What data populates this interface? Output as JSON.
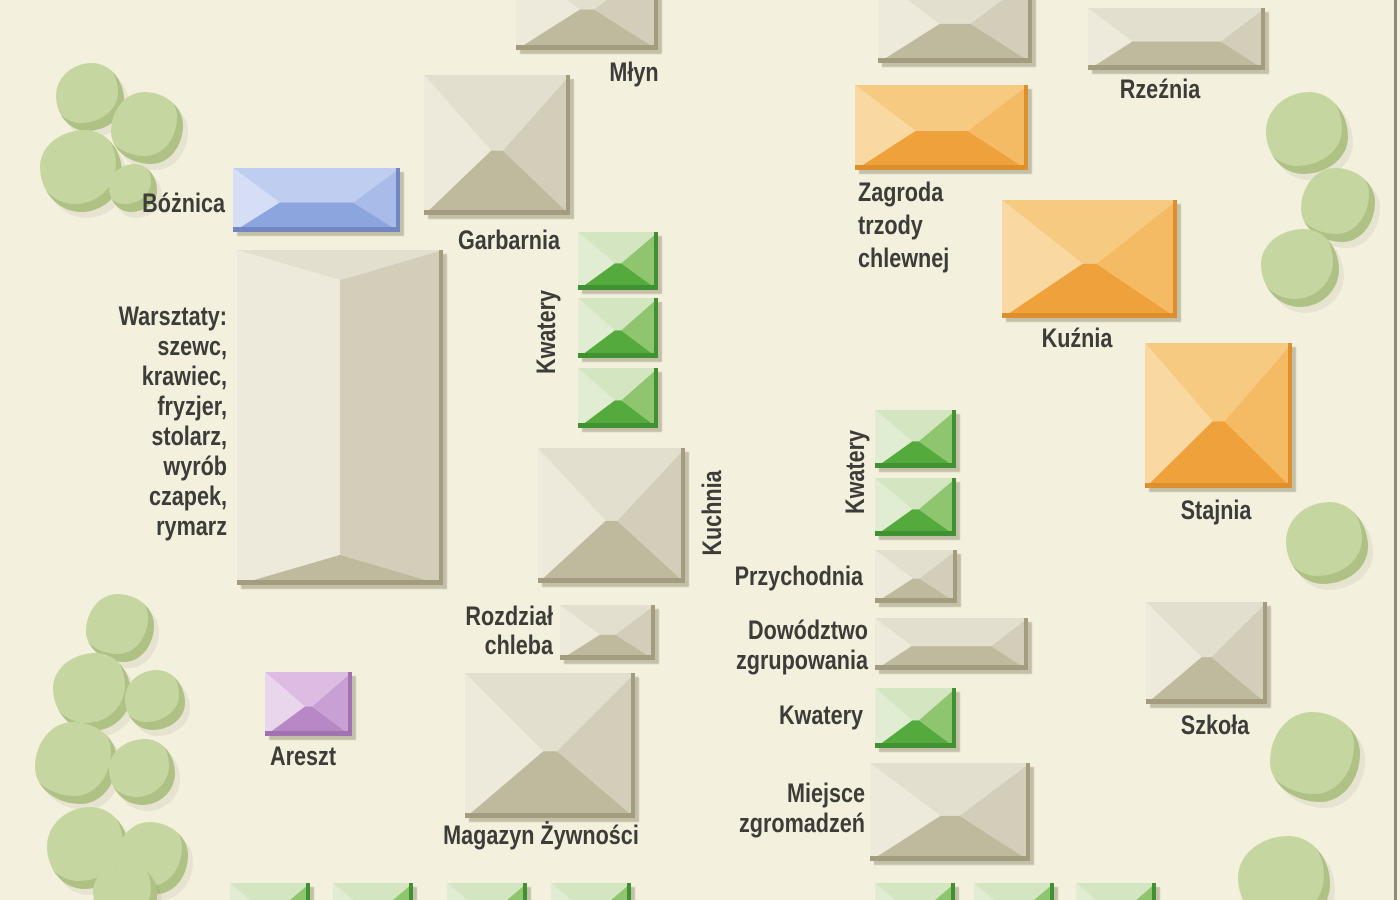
{
  "map": {
    "background_color": "#f3f1de",
    "ink_color": "#3d3c38",
    "right_border_color": "#8d8b79",
    "tree_color": "#c6d6a0",
    "palettes": {
      "tan": {
        "top": "#e2dfce",
        "left": "#edeadc",
        "right": "#d3ceb9",
        "bottom": "#bfb99d",
        "edge": "#a49c7e"
      },
      "green": {
        "top": "#d3e5c1",
        "left": "#e0edd3",
        "right": "#8fc56e",
        "bottom": "#55aa3e",
        "edge": "#3f9132"
      },
      "orange": {
        "top": "#f7ca82",
        "left": "#f9d8a2",
        "right": "#f4bb64",
        "bottom": "#efa23c",
        "edge": "#dc8f2c"
      },
      "blue": {
        "top": "#bfcef0",
        "left": "#d6def6",
        "right": "#a9bbe9",
        "bottom": "#8da5de",
        "edge": "#7286c2"
      },
      "purple": {
        "top": "#dcbce2",
        "left": "#e9d6ec",
        "right": "#c9a0d4",
        "bottom": "#b888c6",
        "edge": "#a172b0"
      }
    },
    "buildings": [
      {
        "id": "mlyn",
        "label": "Młyn",
        "color": "tan",
        "orient": "h",
        "x": 516,
        "y": -38,
        "w": 142,
        "h": 88
      },
      {
        "id": "unlabeled-top",
        "label": "",
        "color": "tan",
        "orient": "h",
        "x": 878,
        "y": -22,
        "w": 154,
        "h": 85
      },
      {
        "id": "rzeznia",
        "label": "Rzeźnia",
        "color": "tan",
        "orient": "h",
        "x": 1088,
        "y": 8,
        "w": 177,
        "h": 62
      },
      {
        "id": "boznica",
        "label": "Bóżnica",
        "color": "blue",
        "orient": "h",
        "x": 233,
        "y": 168,
        "w": 167,
        "h": 64
      },
      {
        "id": "garbarnia",
        "label": "Garbarnia",
        "color": "tan",
        "orient": "h",
        "x": 424,
        "y": 75,
        "w": 146,
        "h": 140
      },
      {
        "id": "warsztaty",
        "label": "Warsztaty",
        "color": "tan",
        "orient": "v",
        "x": 237,
        "y": 250,
        "w": 206,
        "h": 335
      },
      {
        "id": "kwatery-l1",
        "label": "Kwatery",
        "color": "green",
        "orient": "h",
        "x": 578,
        "y": 232,
        "w": 80,
        "h": 58
      },
      {
        "id": "kwatery-l2",
        "label": "Kwatery",
        "color": "green",
        "orient": "h",
        "x": 578,
        "y": 298,
        "w": 80,
        "h": 60
      },
      {
        "id": "kwatery-l3",
        "label": "Kwatery",
        "color": "green",
        "orient": "h",
        "x": 578,
        "y": 368,
        "w": 80,
        "h": 60
      },
      {
        "id": "kuchnia",
        "label": "Kuchnia",
        "color": "tan",
        "orient": "h",
        "x": 538,
        "y": 448,
        "w": 147,
        "h": 135
      },
      {
        "id": "rozdzial-chleba",
        "label": "Rozdział chleba",
        "color": "tan",
        "orient": "h",
        "x": 560,
        "y": 605,
        "w": 95,
        "h": 55
      },
      {
        "id": "magazyn-zywnosci",
        "label": "Magazyn Żywności",
        "color": "tan",
        "orient": "h",
        "x": 465,
        "y": 673,
        "w": 170,
        "h": 145
      },
      {
        "id": "areszt",
        "label": "Areszt",
        "color": "purple",
        "orient": "h",
        "x": 265,
        "y": 672,
        "w": 87,
        "h": 64
      },
      {
        "id": "zagroda",
        "label": "Zagroda trzody chlewnej",
        "color": "orange",
        "orient": "h",
        "x": 855,
        "y": 85,
        "w": 173,
        "h": 85
      },
      {
        "id": "kuznia",
        "label": "Kuźnia",
        "color": "orange",
        "orient": "h",
        "x": 1002,
        "y": 200,
        "w": 175,
        "h": 118
      },
      {
        "id": "stajnia",
        "label": "Stajnia",
        "color": "orange",
        "orient": "h",
        "x": 1145,
        "y": 343,
        "w": 147,
        "h": 145
      },
      {
        "id": "kwatery-r1",
        "label": "Kwatery",
        "color": "green",
        "orient": "h",
        "x": 875,
        "y": 410,
        "w": 81,
        "h": 58
      },
      {
        "id": "kwatery-r2",
        "label": "Kwatery",
        "color": "green",
        "orient": "h",
        "x": 875,
        "y": 478,
        "w": 81,
        "h": 58
      },
      {
        "id": "przychodnia",
        "label": "Przychodnia",
        "color": "tan",
        "orient": "h",
        "x": 875,
        "y": 550,
        "w": 82,
        "h": 53
      },
      {
        "id": "dowodztwo",
        "label": "Dowództwo zgrupowania",
        "color": "tan",
        "orient": "h",
        "x": 875,
        "y": 618,
        "w": 153,
        "h": 52
      },
      {
        "id": "kwatery-single",
        "label": "Kwatery",
        "color": "green",
        "orient": "h",
        "x": 875,
        "y": 688,
        "w": 81,
        "h": 60
      },
      {
        "id": "miejsce-zgromadzen",
        "label": "Miejsce zgromadzeń",
        "color": "tan",
        "orient": "h",
        "x": 870,
        "y": 763,
        "w": 160,
        "h": 98
      },
      {
        "id": "szkola",
        "label": "Szkoła",
        "color": "tan",
        "orient": "h",
        "x": 1146,
        "y": 602,
        "w": 121,
        "h": 102
      },
      {
        "id": "green-bottom-1",
        "label": "",
        "color": "green",
        "orient": "h",
        "x": 230,
        "y": 883,
        "w": 80,
        "h": 58
      },
      {
        "id": "green-bottom-2",
        "label": "",
        "color": "green",
        "orient": "h",
        "x": 333,
        "y": 883,
        "w": 80,
        "h": 58
      },
      {
        "id": "green-bottom-3",
        "label": "",
        "color": "green",
        "orient": "h",
        "x": 447,
        "y": 883,
        "w": 80,
        "h": 58
      },
      {
        "id": "green-bottom-4",
        "label": "",
        "color": "green",
        "orient": "h",
        "x": 551,
        "y": 883,
        "w": 80,
        "h": 58
      },
      {
        "id": "green-bottom-5",
        "label": "",
        "color": "green",
        "orient": "h",
        "x": 875,
        "y": 883,
        "w": 80,
        "h": 58
      },
      {
        "id": "green-bottom-6",
        "label": "",
        "color": "green",
        "orient": "h",
        "x": 974,
        "y": 883,
        "w": 80,
        "h": 58
      },
      {
        "id": "green-bottom-7",
        "label": "",
        "color": "green",
        "orient": "h",
        "x": 1076,
        "y": 883,
        "w": 80,
        "h": 58
      }
    ],
    "labels": [
      {
        "id": "mlyn",
        "text": "Młyn",
        "x": 634,
        "y": 57,
        "align": "center"
      },
      {
        "id": "rzeznia",
        "text": "Rzeźnia",
        "x": 1160,
        "y": 74,
        "align": "center"
      },
      {
        "id": "boznica",
        "text": "Bóżnica",
        "x": 225,
        "y": 188,
        "align": "right"
      },
      {
        "id": "garbarnia",
        "text": "Garbarnia",
        "x": 509,
        "y": 225,
        "align": "center"
      },
      {
        "id": "warsztaty",
        "text": "Warsztaty:\nszewc,\nkrawiec,\nfryzjer,\nstolarz,\nwyrób\nczapek,\nrymarz",
        "x": 227,
        "y": 301,
        "align": "right"
      },
      {
        "id": "kwatery-left",
        "text": "Kwatery",
        "x": 546,
        "y": 332,
        "align": "center",
        "rotate": true
      },
      {
        "id": "kuchnia",
        "text": "Kuchnia",
        "x": 712,
        "y": 513,
        "align": "center",
        "rotate": true
      },
      {
        "id": "rozdzial-chleba",
        "text": "Rozdział\nchleba",
        "x": 553,
        "y": 602,
        "align": "right",
        "lh": 29
      },
      {
        "id": "magazyn-zywnosci",
        "text": "Magazyn Żywności",
        "x": 541,
        "y": 820,
        "align": "center"
      },
      {
        "id": "areszt",
        "text": "Areszt",
        "x": 303,
        "y": 741,
        "align": "center"
      },
      {
        "id": "zagroda",
        "text": "Zagroda\ntrzody\nchlewnej",
        "x": 858,
        "y": 176,
        "align": "left",
        "lh": 33
      },
      {
        "id": "kuznia",
        "text": "Kuźnia",
        "x": 1077,
        "y": 323,
        "align": "center"
      },
      {
        "id": "stajnia",
        "text": "Stajnia",
        "x": 1216,
        "y": 495,
        "align": "center"
      },
      {
        "id": "kwatery-right",
        "text": "Kwatery",
        "x": 855,
        "y": 472,
        "align": "center",
        "rotate": true
      },
      {
        "id": "przychodnia",
        "text": "Przychodnia",
        "x": 863,
        "y": 561,
        "align": "right"
      },
      {
        "id": "dowodztwo",
        "text": "Dowództwo\nzgrupowania",
        "x": 868,
        "y": 615,
        "align": "right",
        "lh": 30
      },
      {
        "id": "kwatery-single",
        "text": "Kwatery",
        "x": 863,
        "y": 700,
        "align": "right"
      },
      {
        "id": "miejsce-zgromadzen",
        "text": "Miejsce\nzgromadzeń",
        "x": 865,
        "y": 778,
        "align": "right",
        "lh": 30
      },
      {
        "id": "szkola",
        "text": "Szkoła",
        "x": 1215,
        "y": 710,
        "align": "center"
      }
    ],
    "trees": [
      {
        "x": 90,
        "y": 97,
        "r": 34
      },
      {
        "x": 147,
        "y": 128,
        "r": 36
      },
      {
        "x": 81,
        "y": 171,
        "r": 41
      },
      {
        "x": 133,
        "y": 188,
        "r": 24
      },
      {
        "x": 120,
        "y": 628,
        "r": 34
      },
      {
        "x": 92,
        "y": 692,
        "r": 39
      },
      {
        "x": 155,
        "y": 700,
        "r": 30
      },
      {
        "x": 76,
        "y": 763,
        "r": 41
      },
      {
        "x": 142,
        "y": 772,
        "r": 33
      },
      {
        "x": 88,
        "y": 848,
        "r": 41
      },
      {
        "x": 152,
        "y": 858,
        "r": 36
      },
      {
        "x": 125,
        "y": 895,
        "r": 32
      },
      {
        "x": 1307,
        "y": 133,
        "r": 41
      },
      {
        "x": 1338,
        "y": 205,
        "r": 37
      },
      {
        "x": 1300,
        "y": 268,
        "r": 39
      },
      {
        "x": 1327,
        "y": 543,
        "r": 41
      },
      {
        "x": 1315,
        "y": 757,
        "r": 45
      },
      {
        "x": 1284,
        "y": 882,
        "r": 46
      }
    ]
  }
}
